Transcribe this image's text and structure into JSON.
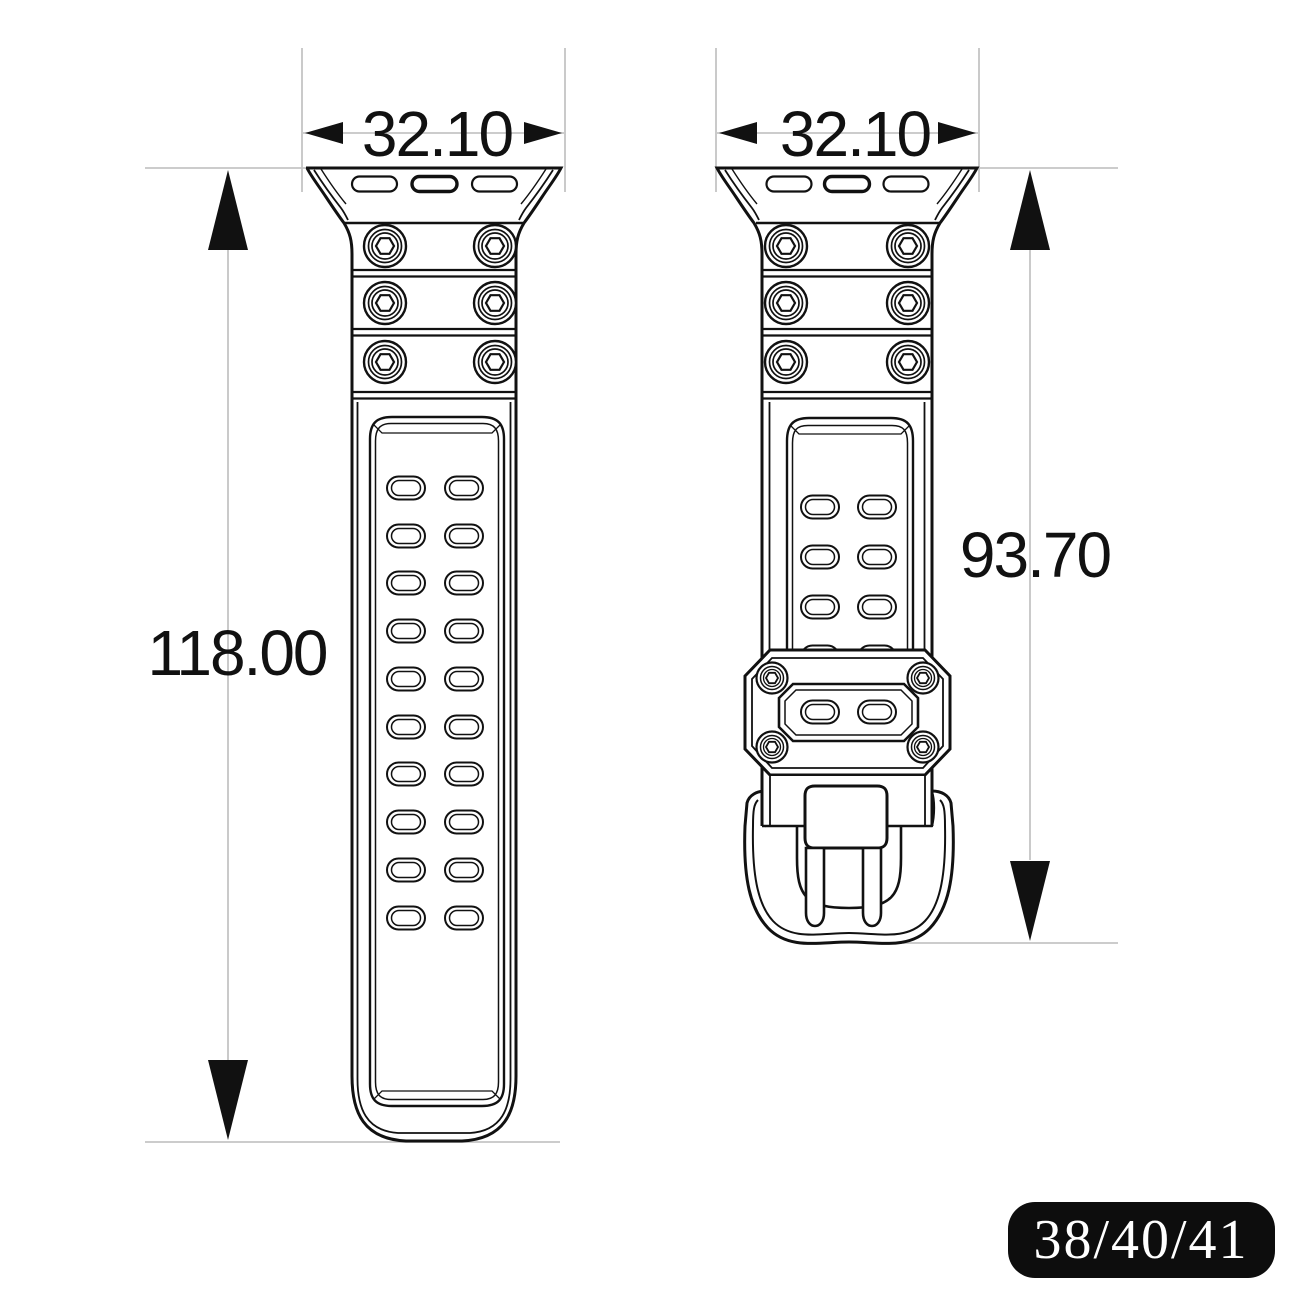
{
  "drawing_title": "watch-band-dimension-drawing",
  "dimensions": {
    "left_band_width_mm": "32.10",
    "right_band_width_mm": "32.10",
    "left_band_length_mm": "118.00",
    "right_band_length_mm": "93.70"
  },
  "badge": {
    "label": "38/40/41"
  },
  "colors": {
    "line": "#111111",
    "dimension_line": "#c4c4c4",
    "badge_bg": "#0d0d0d",
    "badge_text": "#ffffff",
    "background": "#ffffff"
  }
}
